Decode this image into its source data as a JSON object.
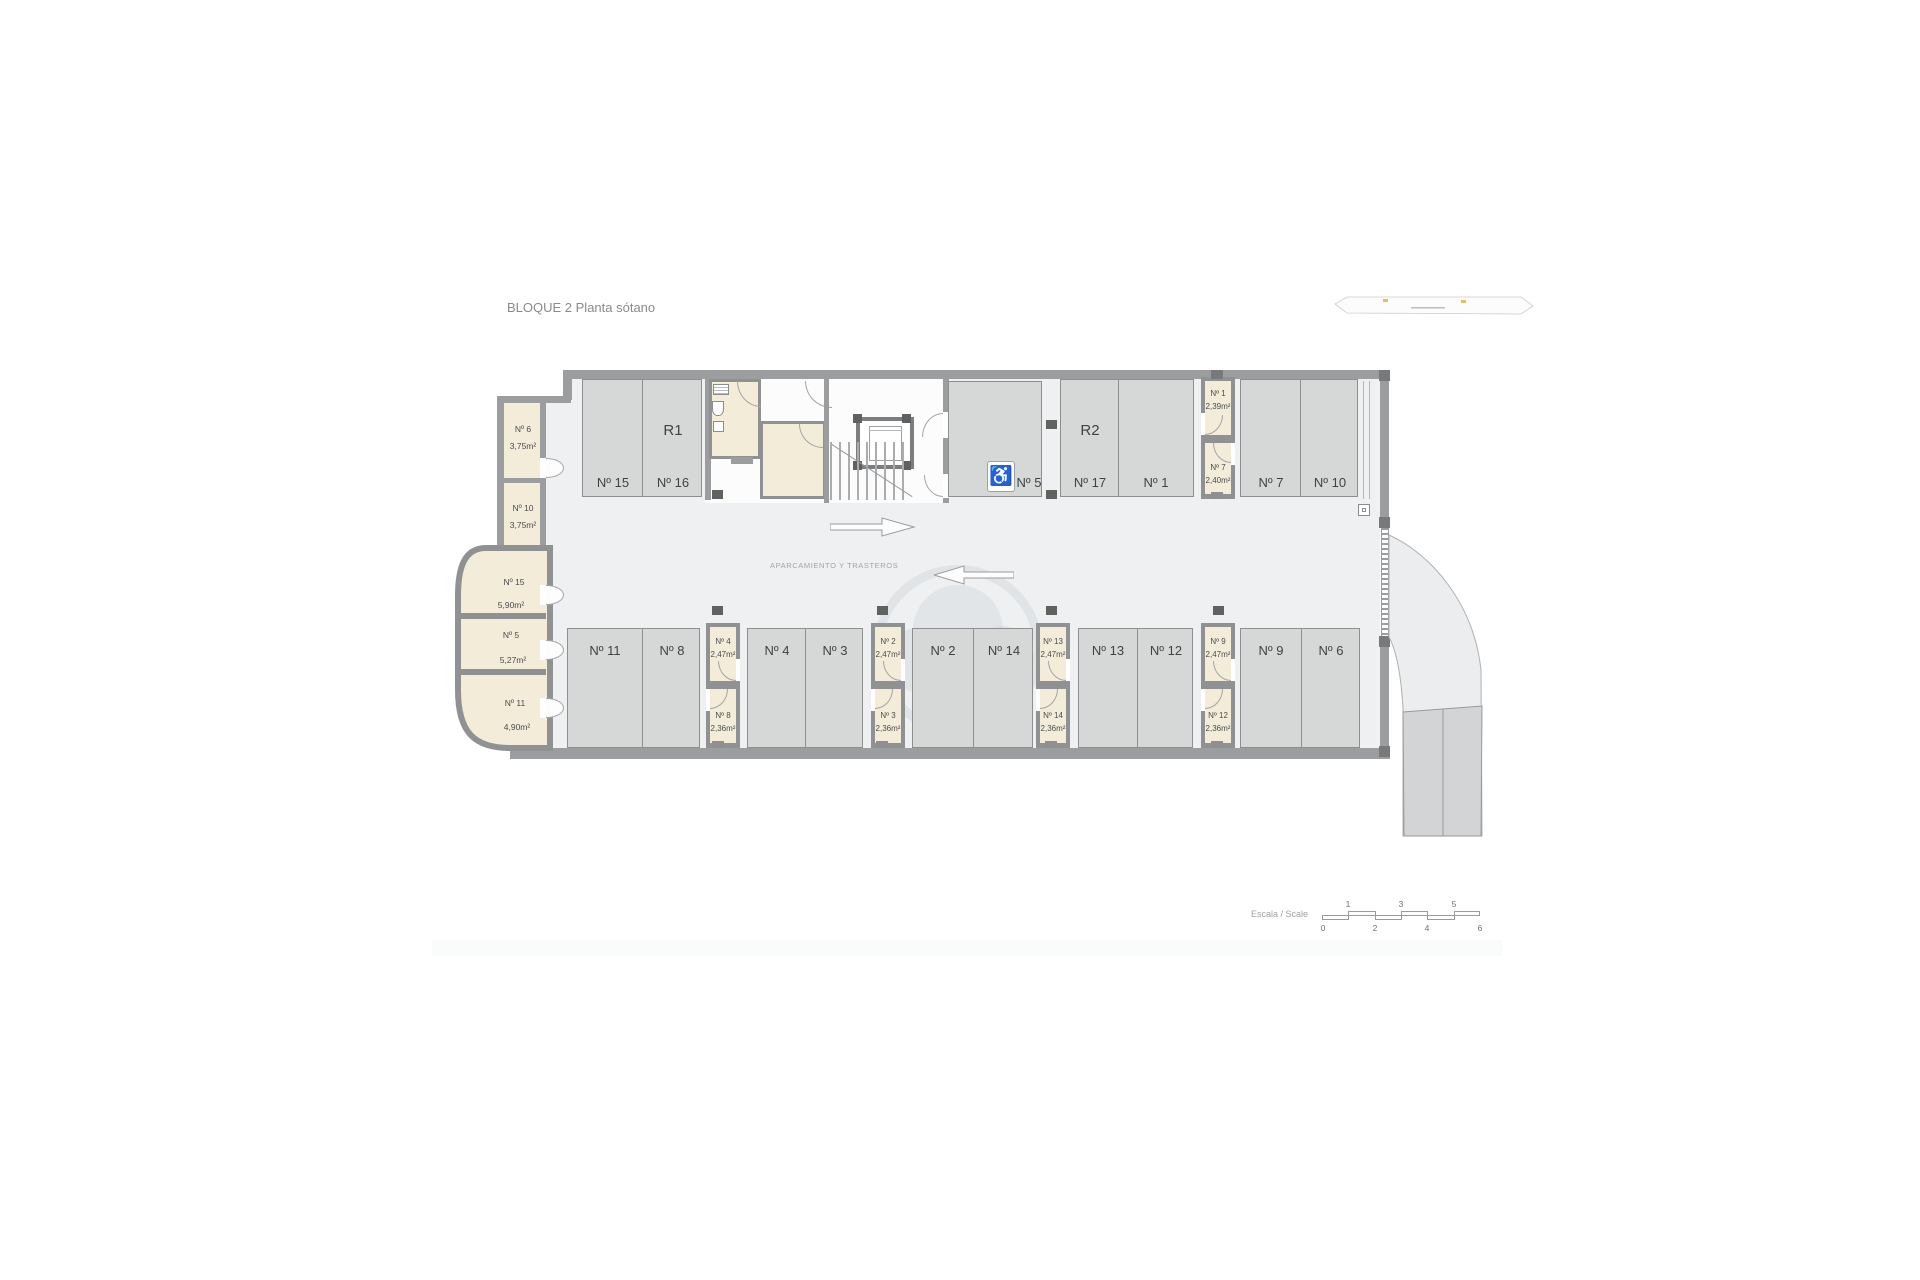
{
  "title": "BLOQUE 2 Planta sótano",
  "aisle_label": "APARCAMIENTO Y TRASTEROS",
  "rooms": {
    "r1": "R1",
    "r2": "R2"
  },
  "accessible_icon": "♿",
  "top_stalls": {
    "s15": "Nº 15",
    "s16": "Nº 16",
    "s5": "Nº 5",
    "s17": "Nº 17",
    "s1": "Nº 1",
    "s7": "Nº 7",
    "s10": "Nº 10"
  },
  "bottom_stalls": {
    "s11": "Nº 11",
    "s8": "Nº 8",
    "s4": "Nº 4",
    "s3": "Nº 3",
    "s2": "Nº 2",
    "s14": "Nº 14",
    "s13": "Nº 13",
    "s12": "Nº 12",
    "s9": "Nº 9",
    "s6": "Nº 6"
  },
  "left_storages": [
    {
      "no": "Nº 6",
      "area": "3,75m²"
    },
    {
      "no": "Nº 10",
      "area": "3,75m²"
    },
    {
      "no": "Nº 15",
      "area": "5,90m²"
    },
    {
      "no": "Nº 5",
      "area": "5,27m²"
    },
    {
      "no": "Nº 11",
      "area": "4,90m²"
    }
  ],
  "top_storage_column": {
    "top": {
      "no": "Nº 1",
      "area": "2,39m²"
    },
    "bottom": {
      "no": "Nº 7",
      "area": "2,40m²"
    }
  },
  "bottom_storage_columns": [
    {
      "top": {
        "no": "Nº 4",
        "area": "2,47m²"
      },
      "bottom": {
        "no": "Nº 8",
        "area": "2,36m²"
      }
    },
    {
      "top": {
        "no": "Nº 2",
        "area": "2,47m²"
      },
      "bottom": {
        "no": "Nº 3",
        "area": "2,36m²"
      }
    },
    {
      "top": {
        "no": "Nº 13",
        "area": "2,47m²"
      },
      "bottom": {
        "no": "Nº 14",
        "area": "2,36m²"
      }
    },
    {
      "top": {
        "no": "Nº 9",
        "area": "2,47m²"
      },
      "bottom": {
        "no": "Nº 12",
        "area": "2,36m²"
      }
    }
  ],
  "scale_bar": {
    "label": "Escala / Scale",
    "above": [
      "1",
      "3",
      "5"
    ],
    "below": [
      "0",
      "2",
      "4",
      "6"
    ]
  },
  "colors": {
    "wall": "#9b9d9f",
    "stall_fill": "#d6d8d8",
    "storage_fill": "#f2ecd9",
    "floor": "#eef0f1",
    "label_text": "#3f4345"
  }
}
